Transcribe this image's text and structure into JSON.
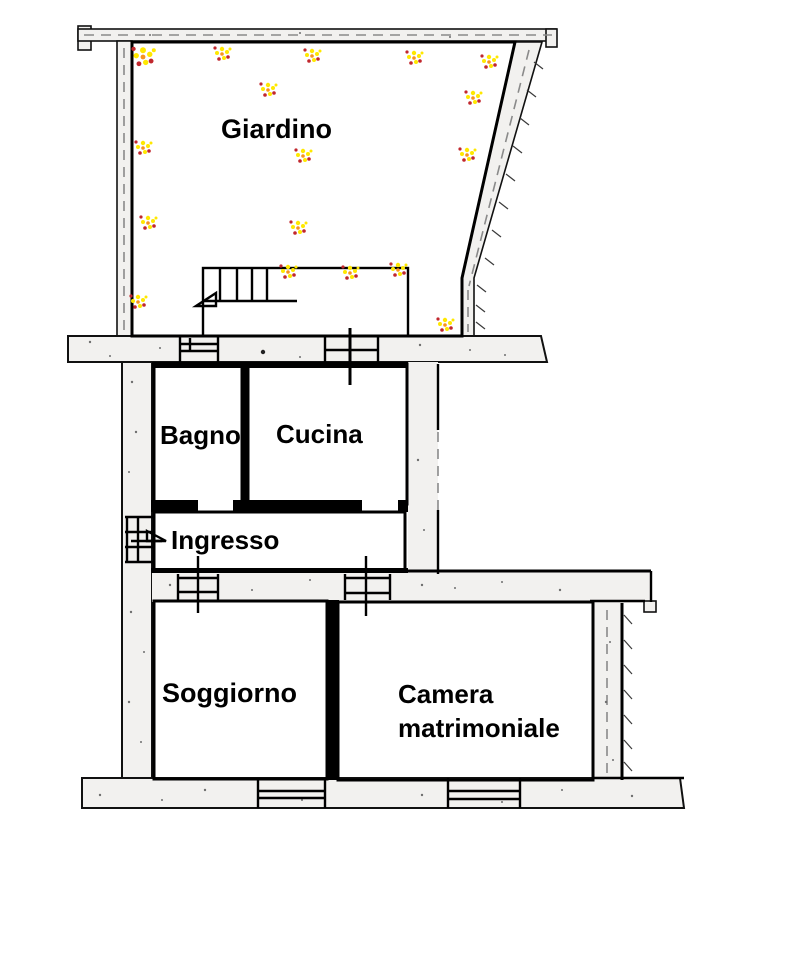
{
  "plan": {
    "title": "Planimetria appartamento con giardino",
    "rooms": {
      "giardino": {
        "label": "Giardino",
        "color": "#2EA445"
      },
      "bagno": {
        "label": "Bagno",
        "color": "#1CA0DF"
      },
      "cucina": {
        "label": "Cucina",
        "color": "#EC1B23"
      },
      "ingresso": {
        "label": "Ingresso",
        "color": "#AFAEAD"
      },
      "soggiorno": {
        "label": "Soggiorno",
        "color": "#FFF200"
      },
      "camera": {
        "label": "Camera matrimoniale",
        "color": "#F7A7C3"
      }
    },
    "features": {
      "stairs_color": "#EDE2B1",
      "wall_fill": "#F2F1EF",
      "outline": "#000000"
    }
  }
}
